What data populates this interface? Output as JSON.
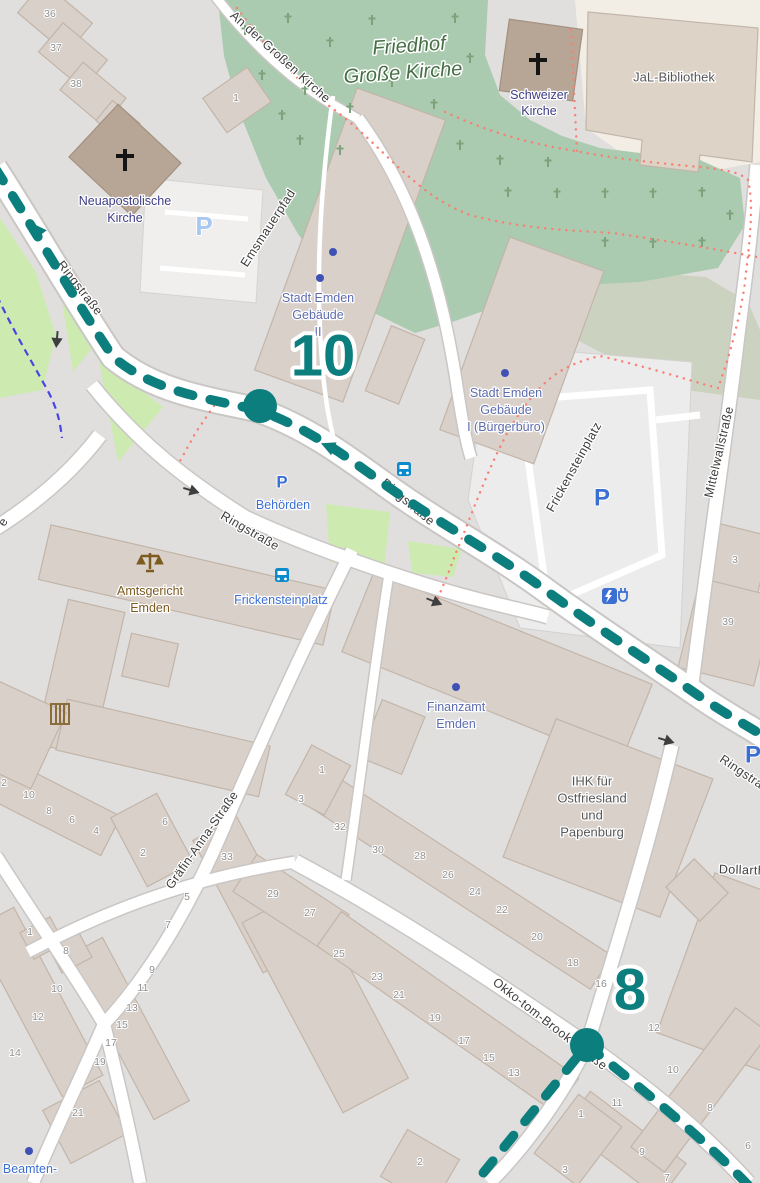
{
  "route": {
    "color": "#0b7e7d",
    "marker_top": "10",
    "marker_bottom": "8"
  },
  "streets": {
    "an_der_grossen_kirche": "An der Großen Kirche"
  },
  "map_labels": [
    {
      "name": "street-label-ringstrasse-nw",
      "text": "Ringstraße",
      "x": 80,
      "y": 288,
      "rot": 52,
      "cls": "street"
    },
    {
      "name": "street-label-ringstrasse-main",
      "text": "Ringstraße",
      "x": 408,
      "y": 502,
      "rot": 40,
      "cls": "street"
    },
    {
      "name": "street-label-ringstrasse-south",
      "text": "Ringstraße",
      "x": 250,
      "y": 531,
      "rot": 30,
      "cls": "street"
    },
    {
      "name": "street-label-ringstrasse-east",
      "text": "Ringstraße",
      "x": 748,
      "y": 776,
      "rot": 34,
      "cls": "street"
    },
    {
      "name": "street-label-emsmauerpfad",
      "text": "Emsmauerpfad",
      "x": 268,
      "y": 228,
      "rot": -57,
      "cls": "street"
    },
    {
      "name": "street-label-mittelwallstrasse",
      "text": "Mittelwallstraße",
      "x": 719,
      "y": 452,
      "rot": -77,
      "cls": "street"
    },
    {
      "name": "street-label-frickensteinplatz",
      "text": "Frickensteinplatz",
      "x": 574,
      "y": 467,
      "rot": -61,
      "cls": "street"
    },
    {
      "name": "street-label-graefin-anna-strasse",
      "text": "Gräfin-Anna-Straße",
      "x": 202,
      "y": 840,
      "rot": -55,
      "cls": "street"
    },
    {
      "name": "street-label-okko-tom-brook-strasse",
      "text": "Okko-tom-Brook-Straße",
      "x": 550,
      "y": 1024,
      "rot": 38,
      "cls": "street"
    },
    {
      "name": "street-label-dollarth",
      "text": "Dollarth",
      "x": 742,
      "y": 870,
      "rot": 2,
      "cls": "street"
    },
    {
      "name": "street-label-fragment",
      "text": "e",
      "x": 3,
      "y": 522,
      "rot": -60,
      "cls": "street"
    },
    {
      "name": "poi-label-stadt-emden-2-line1",
      "text": "Stadt Emden",
      "x": 318,
      "y": 298,
      "rot": 0,
      "cls": "civic"
    },
    {
      "name": "poi-label-stadt-emden-2-line2",
      "text": "Gebäude",
      "x": 318,
      "y": 315,
      "rot": 0,
      "cls": "civic"
    },
    {
      "name": "poi-label-stadt-emden-2-line3",
      "text": "II",
      "x": 318,
      "y": 332,
      "rot": 0,
      "cls": "civic"
    },
    {
      "name": "poi-label-stadt-emden-1-line1",
      "text": "Stadt Emden",
      "x": 506,
      "y": 393,
      "rot": 0,
      "cls": "civic"
    },
    {
      "name": "poi-label-stadt-emden-1-line2",
      "text": "Gebäude",
      "x": 506,
      "y": 410,
      "rot": 0,
      "cls": "civic"
    },
    {
      "name": "poi-label-stadt-emden-1-line3",
      "text": "I (Bürgerbüro)",
      "x": 506,
      "y": 427,
      "rot": 0,
      "cls": "civic"
    },
    {
      "name": "poi-label-finanzamt-line1",
      "text": "Finanzamt",
      "x": 456,
      "y": 707,
      "rot": 0,
      "cls": "civic"
    },
    {
      "name": "poi-label-finanzamt-line2",
      "text": "Emden",
      "x": 456,
      "y": 724,
      "rot": 0,
      "cls": "civic"
    },
    {
      "name": "poi-label-schweizer-kirche-line1",
      "text": "Schweizer",
      "x": 539,
      "y": 95,
      "rot": 0,
      "cls": "church"
    },
    {
      "name": "poi-label-schweizer-kirche-line2",
      "text": "Kirche",
      "x": 539,
      "y": 111,
      "rot": 0,
      "cls": "church"
    },
    {
      "name": "poi-label-neuapostolische-line1",
      "text": "Neuapostolische",
      "x": 125,
      "y": 201,
      "rot": 0,
      "cls": "church"
    },
    {
      "name": "poi-label-neuapostolische-line2",
      "text": "Kirche",
      "x": 125,
      "y": 218,
      "rot": 0,
      "cls": "church"
    },
    {
      "name": "poi-label-jal-bibliothek",
      "text": "JaL-Bibliothek",
      "x": 674,
      "y": 77,
      "rot": 0,
      "cls": "graylbl"
    },
    {
      "name": "poi-label-ihk-line1",
      "text": "IHK für",
      "x": 592,
      "y": 781,
      "rot": 0,
      "cls": "graylbl"
    },
    {
      "name": "poi-label-ihk-line2",
      "text": "Ostfriesland",
      "x": 592,
      "y": 798,
      "rot": 0,
      "cls": "graylbl"
    },
    {
      "name": "poi-label-ihk-line3",
      "text": "und",
      "x": 592,
      "y": 815,
      "rot": 0,
      "cls": "graylbl"
    },
    {
      "name": "poi-label-ihk-line4",
      "text": "Papenburg",
      "x": 592,
      "y": 832,
      "rot": 0,
      "cls": "graylbl"
    },
    {
      "name": "poi-label-amtsgericht-line1",
      "text": "Amtsgericht",
      "x": 150,
      "y": 591,
      "rot": 0,
      "cls": "brownlbl"
    },
    {
      "name": "poi-label-amtsgericht-line2",
      "text": "Emden",
      "x": 150,
      "y": 608,
      "rot": 0,
      "cls": "brownlbl"
    },
    {
      "name": "poi-label-behoerden",
      "text": "Behörden",
      "x": 283,
      "y": 505,
      "rot": 0,
      "cls": "translbl"
    },
    {
      "name": "transit-label-frickensteinplatz",
      "text": "Frickensteinplatz",
      "x": 281,
      "y": 600,
      "rot": 0,
      "cls": "translbl"
    },
    {
      "name": "poi-label-beamten",
      "text": "Beamten-",
      "x": 30,
      "y": 1169,
      "rot": 0,
      "cls": "translbl"
    },
    {
      "name": "cemetery-label-line1",
      "text": "Friedhof",
      "x": 409,
      "y": 46,
      "rot": -4,
      "cls": "cemlbl"
    },
    {
      "name": "cemetery-label-line2",
      "text": "Große Kirche",
      "x": 403,
      "y": 73,
      "rot": -4,
      "cls": "cemlbl"
    }
  ],
  "house_numbers": [
    {
      "t": "36",
      "x": 50,
      "y": 14
    },
    {
      "t": "37",
      "x": 56,
      "y": 48
    },
    {
      "t": "38",
      "x": 76,
      "y": 84
    },
    {
      "t": "1",
      "x": 236,
      "y": 98
    },
    {
      "t": "2",
      "x": 4,
      "y": 783
    },
    {
      "t": "10",
      "x": 29,
      "y": 795
    },
    {
      "t": "8",
      "x": 49,
      "y": 811
    },
    {
      "t": "6",
      "x": 72,
      "y": 820
    },
    {
      "t": "4",
      "x": 96,
      "y": 831
    },
    {
      "t": "6",
      "x": 165,
      "y": 822
    },
    {
      "t": "2",
      "x": 143,
      "y": 853
    },
    {
      "t": "33",
      "x": 227,
      "y": 857
    },
    {
      "t": "5",
      "x": 187,
      "y": 897
    },
    {
      "t": "7",
      "x": 168,
      "y": 925
    },
    {
      "t": "29",
      "x": 273,
      "y": 894
    },
    {
      "t": "27",
      "x": 310,
      "y": 913
    },
    {
      "t": "25",
      "x": 339,
      "y": 954
    },
    {
      "t": "23",
      "x": 377,
      "y": 977
    },
    {
      "t": "21",
      "x": 399,
      "y": 995
    },
    {
      "t": "19",
      "x": 435,
      "y": 1018
    },
    {
      "t": "17",
      "x": 464,
      "y": 1041
    },
    {
      "t": "15",
      "x": 489,
      "y": 1058
    },
    {
      "t": "13",
      "x": 514,
      "y": 1073
    },
    {
      "t": "1",
      "x": 322,
      "y": 770
    },
    {
      "t": "3",
      "x": 301,
      "y": 799
    },
    {
      "t": "32",
      "x": 340,
      "y": 827
    },
    {
      "t": "30",
      "x": 378,
      "y": 850
    },
    {
      "t": "28",
      "x": 420,
      "y": 856
    },
    {
      "t": "26",
      "x": 448,
      "y": 875
    },
    {
      "t": "24",
      "x": 475,
      "y": 892
    },
    {
      "t": "22",
      "x": 502,
      "y": 910
    },
    {
      "t": "20",
      "x": 537,
      "y": 937
    },
    {
      "t": "18",
      "x": 573,
      "y": 963
    },
    {
      "t": "16",
      "x": 601,
      "y": 984
    },
    {
      "t": "1",
      "x": 30,
      "y": 932
    },
    {
      "t": "8",
      "x": 66,
      "y": 951
    },
    {
      "t": "10",
      "x": 57,
      "y": 989
    },
    {
      "t": "12",
      "x": 38,
      "y": 1017
    },
    {
      "t": "14",
      "x": 15,
      "y": 1053
    },
    {
      "t": "9",
      "x": 152,
      "y": 970
    },
    {
      "t": "11",
      "x": 143,
      "y": 988
    },
    {
      "t": "13",
      "x": 132,
      "y": 1008
    },
    {
      "t": "15",
      "x": 122,
      "y": 1025
    },
    {
      "t": "17",
      "x": 111,
      "y": 1043
    },
    {
      "t": "19",
      "x": 100,
      "y": 1062
    },
    {
      "t": "21",
      "x": 78,
      "y": 1113
    },
    {
      "t": "3",
      "x": 735,
      "y": 560
    },
    {
      "t": "39",
      "x": 728,
      "y": 622
    },
    {
      "t": "12",
      "x": 654,
      "y": 1028
    },
    {
      "t": "10",
      "x": 673,
      "y": 1070
    },
    {
      "t": "8",
      "x": 710,
      "y": 1108
    },
    {
      "t": "6",
      "x": 748,
      "y": 1146
    },
    {
      "t": "11",
      "x": 617,
      "y": 1103
    },
    {
      "t": "9",
      "x": 642,
      "y": 1152
    },
    {
      "t": "1",
      "x": 581,
      "y": 1114
    },
    {
      "t": "3",
      "x": 565,
      "y": 1170
    },
    {
      "t": "2",
      "x": 420,
      "y": 1162
    },
    {
      "t": "7",
      "x": 667,
      "y": 1178
    }
  ],
  "parking_icons": [
    {
      "x": 282,
      "y": 482,
      "style": "strong",
      "size": 17
    },
    {
      "x": 602,
      "y": 498,
      "style": "strong",
      "size": 24
    },
    {
      "x": 753,
      "y": 755,
      "style": "strong",
      "size": 24
    },
    {
      "x": 204,
      "y": 226,
      "style": "light",
      "size": 26
    }
  ],
  "icons": {
    "parking_glyph": "P"
  }
}
